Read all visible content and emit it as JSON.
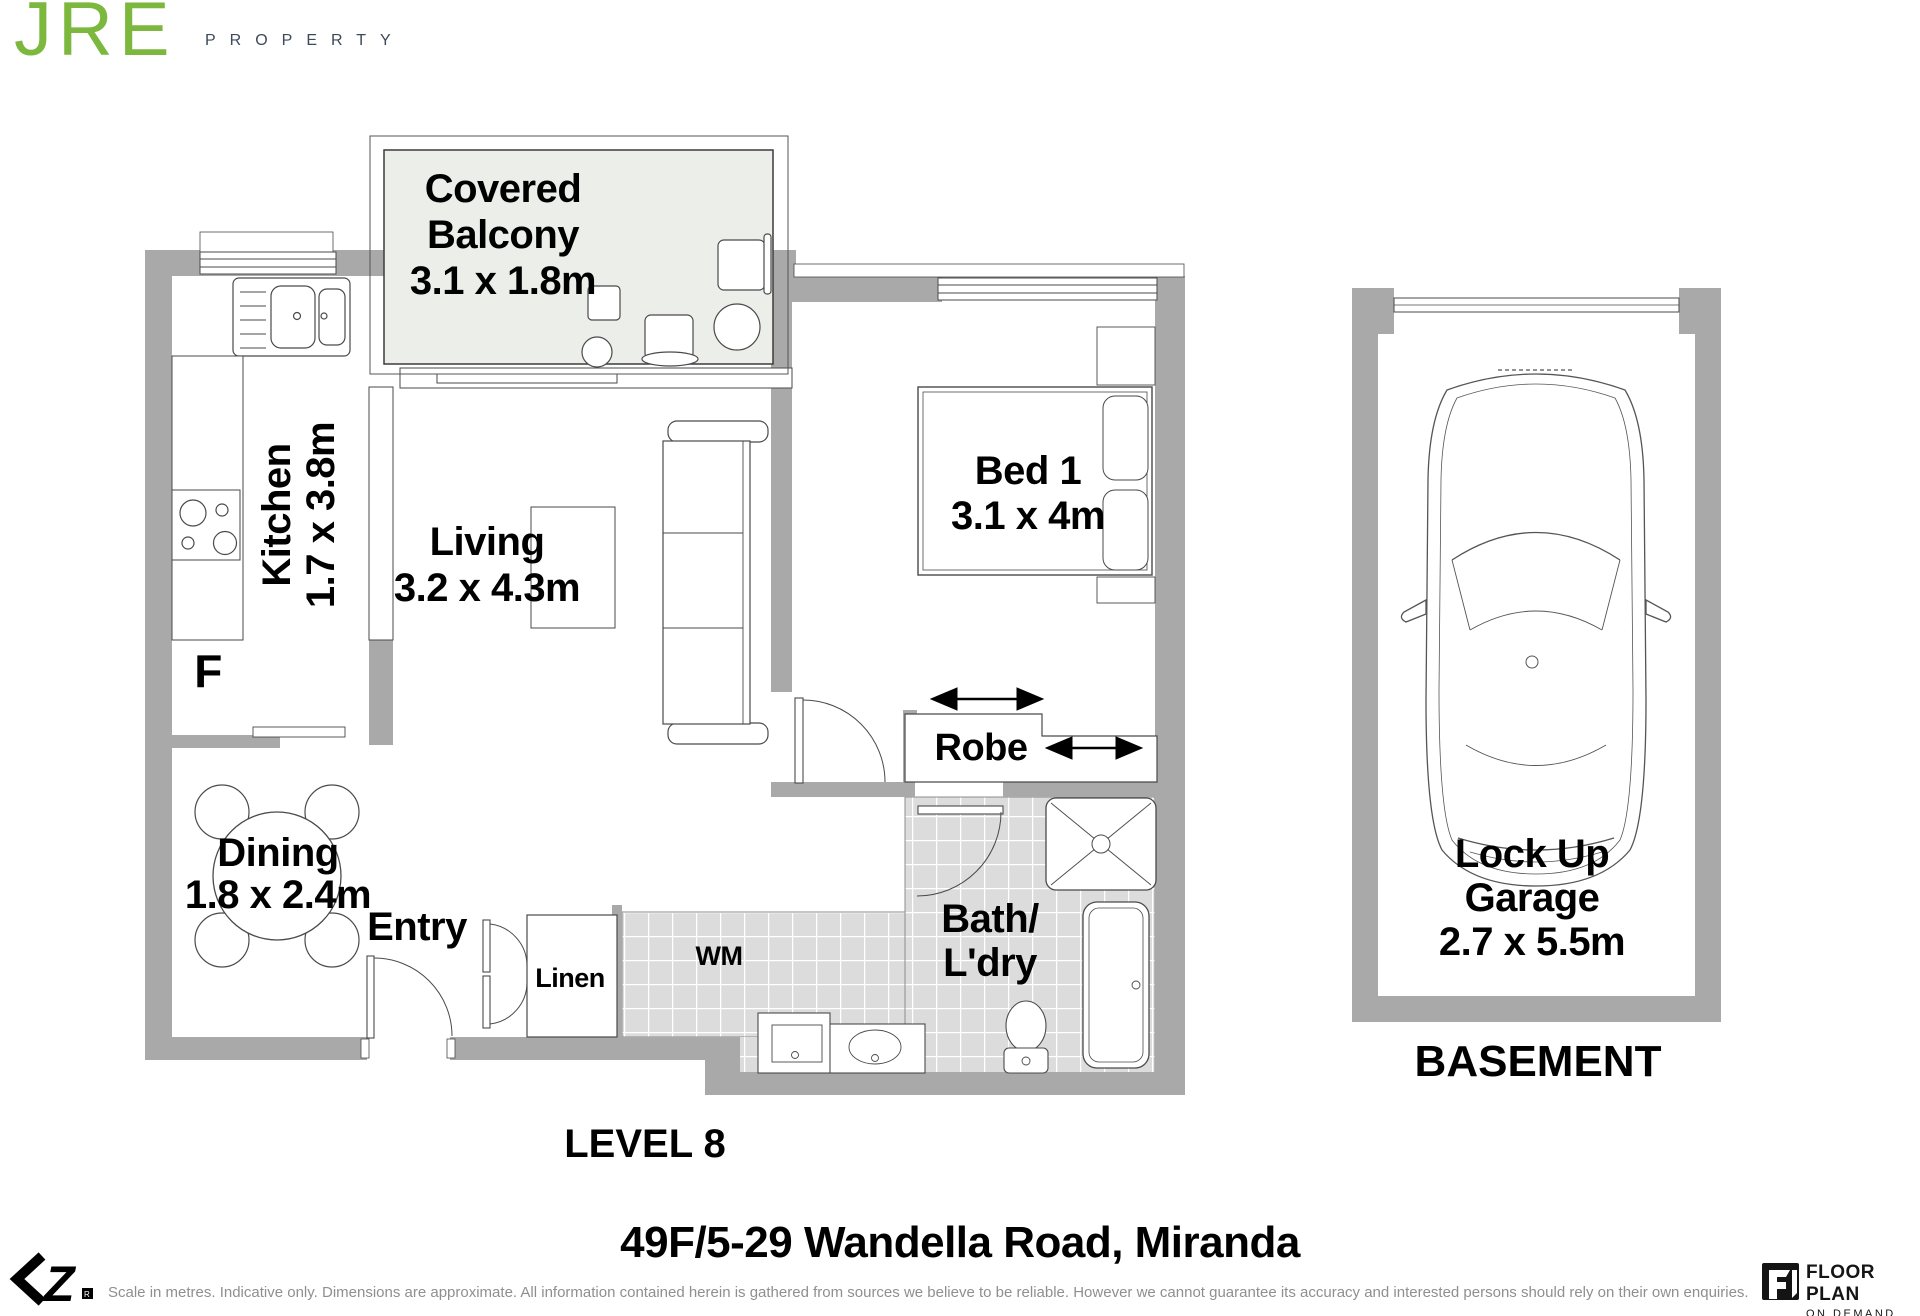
{
  "brand": {
    "name": "JRE",
    "tagline": "PROPERTY",
    "name_color": "#7cb83e",
    "tagline_color": "#3d4a5a"
  },
  "rooms": {
    "balcony": {
      "line1": "Covered",
      "line2": "Balcony",
      "dims": "3.1 x 1.8m"
    },
    "kitchen": {
      "name": "Kitchen",
      "dims": "1.7 x 3.8m"
    },
    "living": {
      "name": "Living",
      "dims": "3.2 x 4.3m"
    },
    "bed1": {
      "name": "Bed 1",
      "dims": "3.1 x 4m"
    },
    "robe": {
      "name": "Robe"
    },
    "dining": {
      "name": "Dining",
      "dims": "1.8 x 2.4m"
    },
    "entry": {
      "name": "Entry"
    },
    "linen": {
      "name": "Linen"
    },
    "laundry": {
      "wm": "WM"
    },
    "bath": {
      "line1": "Bath/",
      "line2": "L'dry"
    },
    "fridge": {
      "abbr": "F"
    },
    "garage": {
      "line1": "Lock Up",
      "line2": "Garage",
      "dims": "2.7 x 5.5m"
    }
  },
  "levels": {
    "apartment": "LEVEL 8",
    "garage": "BASEMENT"
  },
  "address": "49F/5-29 Wandella Road, Miranda",
  "disclaimer": "Scale in metres. Indicative only. Dimensions are approximate. All information contained herein is gathered from sources we believe to be reliable. However we cannot guarantee its accuracy and interested persons should rely on their own enquiries.",
  "credit": {
    "line1": "FLOOR PLAN",
    "line2": "ON DEMAND"
  },
  "colors": {
    "wall": "#a9a9a9",
    "balcony_fill": "#eceeea",
    "tile_fill": "#dcdcdc",
    "line": "#3c3c3c"
  }
}
